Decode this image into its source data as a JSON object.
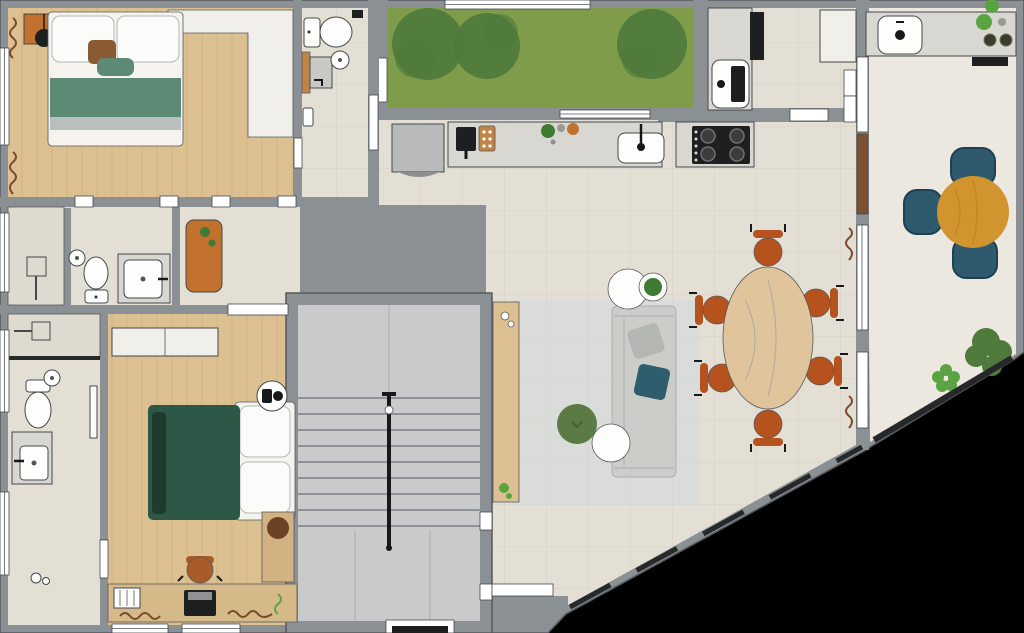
{
  "plan": {
    "title": "apartment-floor-plan",
    "rooms": [
      {
        "name": "bedroom-1",
        "furniture": [
          "double-bed",
          "nightstand",
          "table-lamp",
          "built-in-wardrobe",
          "curtains"
        ]
      },
      {
        "name": "bathroom-1",
        "furniture": [
          "toilet",
          "round-basin",
          "shower",
          "wood-shelf"
        ]
      },
      {
        "name": "garden-courtyard",
        "furniture": [
          "lawn",
          "tree",
          "tree",
          "tree"
        ]
      },
      {
        "name": "kitchen",
        "furniture": [
          "fridge",
          "coffee-machine",
          "cutting-board",
          "kitchen-sink",
          "gas-hob"
        ]
      },
      {
        "name": "utility-area",
        "furniture": [
          "laundry-sink",
          "tall-cabinet"
        ]
      },
      {
        "name": "hallway",
        "furniture": [
          "console-table"
        ]
      },
      {
        "name": "bathroom-2",
        "furniture": [
          "shower",
          "toilet",
          "round-mirror",
          "vanity-sink"
        ]
      },
      {
        "name": "staircase",
        "furniture": [
          "handrail"
        ]
      },
      {
        "name": "living-room",
        "furniture": [
          "sofa",
          "rug",
          "pouf",
          "side-table",
          "side-table",
          "media-console",
          "potted-plant"
        ]
      },
      {
        "name": "dining-area",
        "furniture": [
          "oval-dining-table",
          "dining-chair-x6",
          "curtains"
        ]
      },
      {
        "name": "bedroom-2",
        "furniture": [
          "double-bed",
          "wardrobe",
          "desk",
          "desk-chair",
          "laptop",
          "pouf",
          "fan-unit",
          "curtains"
        ]
      },
      {
        "name": "ensuite-bathroom",
        "furniture": [
          "shower",
          "toilet",
          "round-basin",
          "vanity-sink",
          "towel-rail"
        ]
      },
      {
        "name": "terrace",
        "furniture": [
          "outdoor-counter",
          "outdoor-sink",
          "round-table",
          "wicker-chair-x3",
          "plants"
        ]
      }
    ]
  },
  "palette": {
    "outside": "#000000",
    "wall": "#8b9094",
    "wall_dark": "#595d60",
    "floor_main": "#e4dfd5",
    "floor_wood": "#dcc091",
    "closet": "#f0efe9",
    "terrace_floor": "#ece8df",
    "stair_floor": "#c9cbca",
    "grass": "#7f9c4b",
    "tree": "#4f7a3b",
    "counter": "#d8d7d2",
    "fridge": "#b9bbba",
    "appliance_black": "#1d1f20",
    "fixture_white": "#fdfdfb",
    "bed_white": "#f4f3ee",
    "bed_green": "#5d8a74",
    "bed_gray": "#b9bfbf",
    "bed_dark_green": "#2d5848",
    "bed_fold": "#1e3b2e",
    "pillow_brown": "#8a5a34",
    "wood_furniture": "#c08448",
    "orange_furniture": "#c2702e",
    "chair_rust": "#b5521d",
    "desk_chair": "#a85c28",
    "table_wood": "#dfc49c",
    "rug": "#d9dcd8",
    "sofa": "#c7c8c4",
    "pillow_teal": "#2e5e6d",
    "pillow_gray": "#b4b6b2",
    "pouf_green": "#5c7a43",
    "balcony_table": "#d1942f",
    "balcony_chair": "#2f5a6e",
    "plant_green": "#3e7c35",
    "plant_light": "#5aa342",
    "curtain": "#7a4a2a",
    "door_wood": "#7a5230",
    "glass": "#26282a",
    "pouf_brown": "#6b4226",
    "shower_floor": "#dedacf",
    "side_table_wood": "#d2b183",
    "desk_wood": "#d5b988",
    "gray_box": "#c9c8c4"
  }
}
